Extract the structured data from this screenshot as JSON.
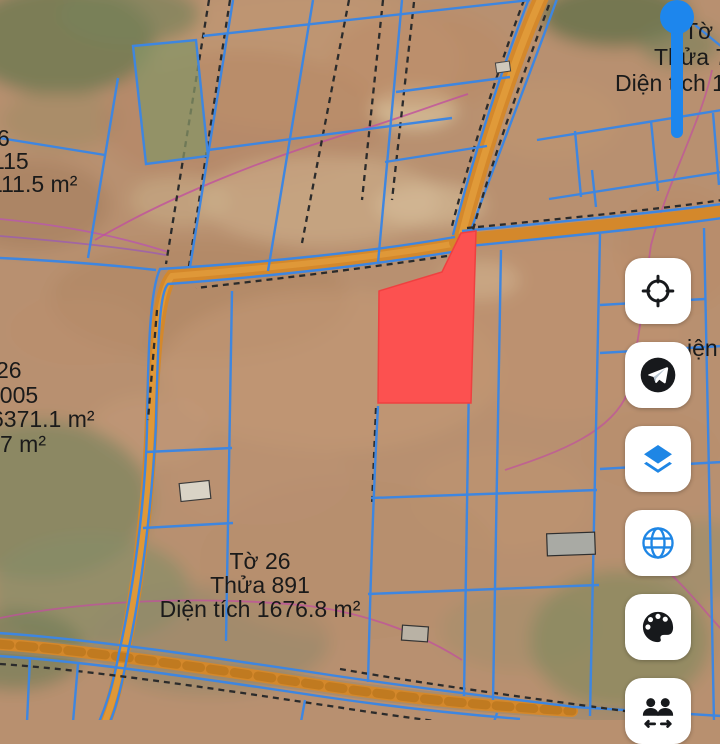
{
  "view": {
    "type": "satellite-cadastral-map"
  },
  "parcel_labels": {
    "top_right": {
      "lines": [
        "Tờ 2",
        "Thửa 7",
        "Diện tích 10"
      ]
    },
    "left_upper": {
      "lines": [
        "6",
        "115",
        "111.5 m²"
      ]
    },
    "left_middle": {
      "lines": [
        "26",
        "3005",
        "6371.1 m²",
        "7 m²"
      ]
    },
    "bottom_center": {
      "lines": [
        "Tờ 26",
        "Thửa 891",
        "Diện tích 1676.8 m²"
      ]
    },
    "right_clipped": {
      "lines": [
        "iện"
      ]
    }
  },
  "selected_parcel": {
    "fill": "#fc5150"
  },
  "marker": {
    "shape": "pin",
    "color": "#1d86ed"
  },
  "toolbar": {
    "buttons": [
      {
        "icon": "locate-icon"
      },
      {
        "icon": "send-icon"
      },
      {
        "icon": "layers-icon"
      },
      {
        "icon": "globe-icon"
      },
      {
        "icon": "palette-icon"
      },
      {
        "icon": "users-icon"
      }
    ]
  },
  "colors": {
    "parcel_line": "#3e86e0",
    "road": "#d4882b",
    "boundary_pink": "#c0509e",
    "label_text": "#1a1a1a",
    "button_bg": "#ffffff",
    "icon_blue": "#1e86e5",
    "icon_black": "#17191c",
    "pin_blue": "#1d86ed"
  }
}
